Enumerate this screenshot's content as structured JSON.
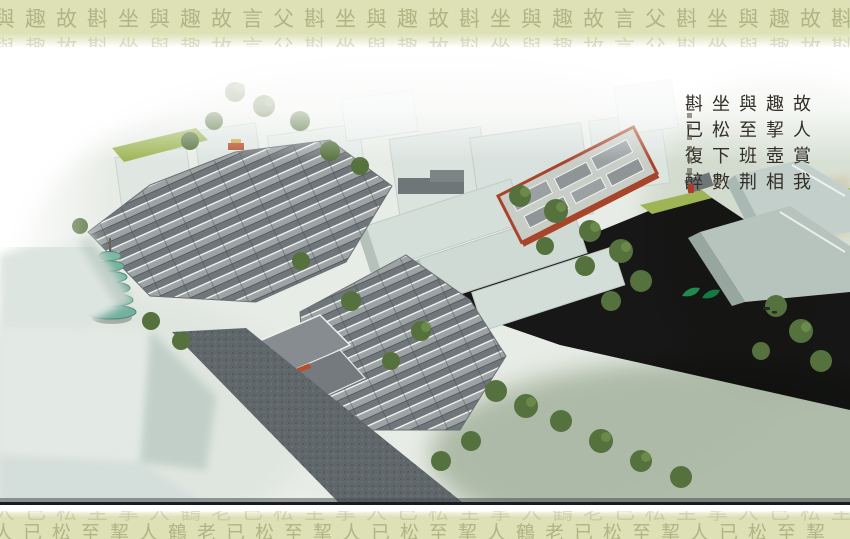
{
  "borders": {
    "top_row": "與趣故斟坐與趣故言父斟坐與趣故斟坐與趣故言父斟坐與趣故斟坐",
    "bottom_row": "人已松至挈人鶴老已松至挈人已松至挈人鶴老已松至挈人已松至挈"
  },
  "poem": {
    "full_text": "故人賞我趣 挈壺相與至 班荆坐松下 數斟已復醉",
    "columns": [
      "故人賞我",
      "趣挈壺相",
      "與至班荆",
      "坐松下數",
      "斟已復醉"
    ]
  },
  "colors": {
    "band_background": "#dde1b5",
    "band_text": "#94996a",
    "ink": "#332e28",
    "seal_red": "#b03a2a",
    "roof_gray": "#70777a",
    "massing_gray": "#dde6e1",
    "tree_green": "#55713d",
    "lawn_green": "#9db554",
    "road_gray": "#5f666a",
    "pagoda_teal": "#73b09e",
    "temple_red": "#a8442a",
    "leaf_sculpture_green": "#1e8c4f"
  }
}
